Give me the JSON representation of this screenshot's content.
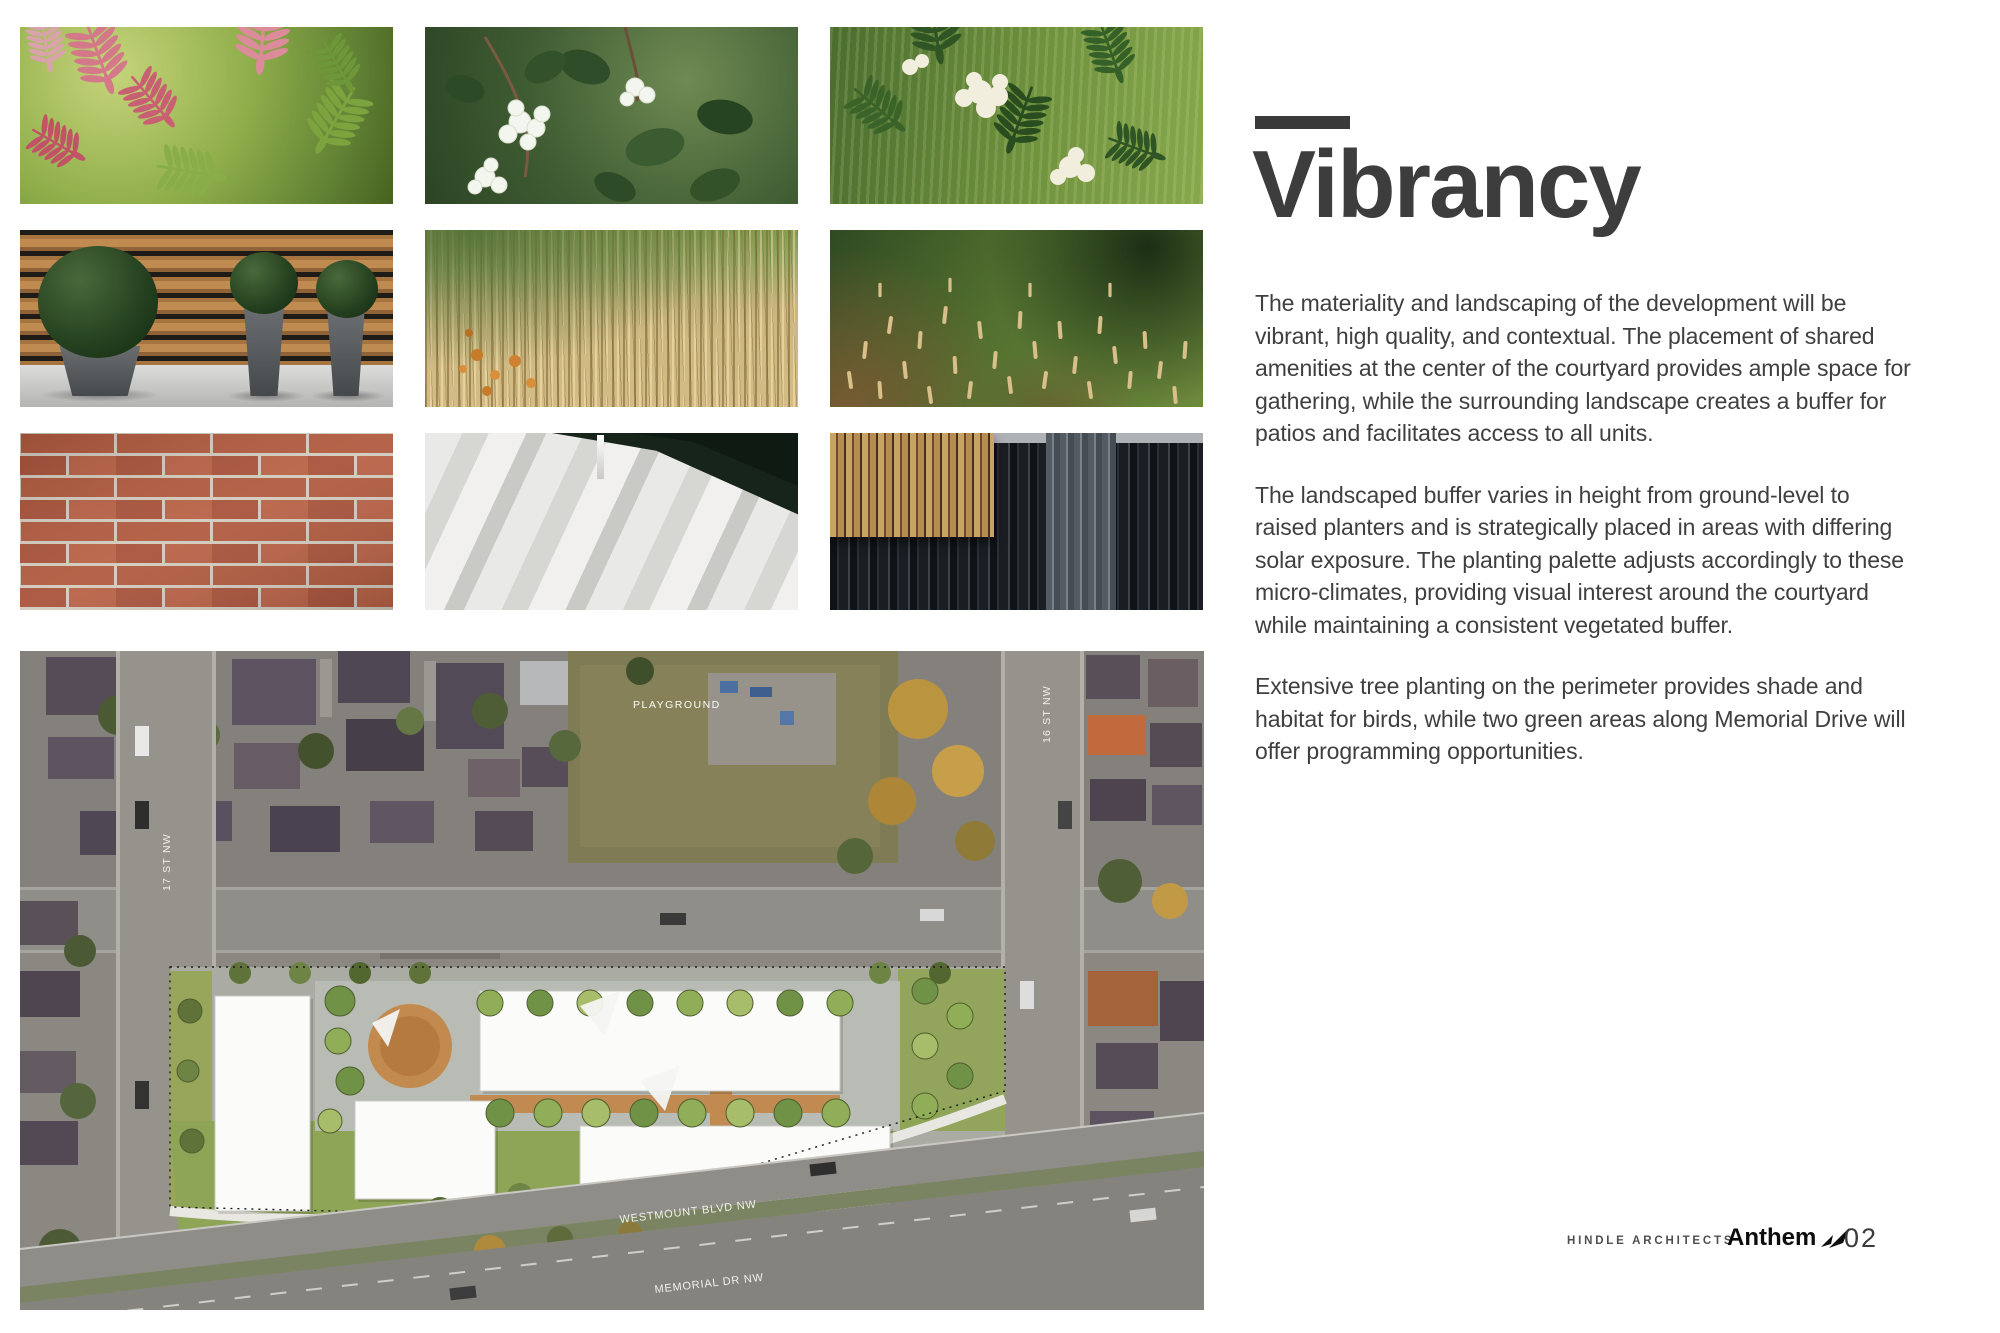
{
  "header": {
    "title": "Vibrancy"
  },
  "body": {
    "paragraphs": [
      "The materiality and landscaping of the development will be vibrant, high quality, and contextual. The placement of shared amenities at the center of the courtyard provides ample space for gathering, while the surrounding landscape creates a buffer for patios and facilitates access to all units.",
      "The landscaped buffer varies in height from ground-level to raised planters and is strategically placed in areas with differing solar exposure. The planting palette adjusts accordingly to these micro-climates, providing visual interest around the courtyard while maintaining a consistent vegetated buffer.",
      "Extensive tree planting on the perimeter provides shade and habitat for birds, while two green areas along Memorial Drive will offer programming opportunities."
    ]
  },
  "footer": {
    "architect": "HINDLE ARCHITECTS",
    "brand": "Anthem",
    "page_number": "02"
  },
  "site_plan": {
    "labels": {
      "playground": "PLAYGROUND",
      "street_left": "17 ST NW",
      "street_right": "16 ST NW",
      "boulevard": "WESTMOUNT BLVD NW",
      "drive": "MEMORIAL DR NW"
    }
  },
  "photos": [
    "false-spirea-pink-foliage",
    "snowberry-white-berries",
    "white-flower-shrub",
    "boxwood-topiary-planters",
    "feather-reed-grass",
    "mugo-pine-shrubs",
    "red-brick-wall",
    "concrete-paver-walkway",
    "wood-slat-and-metal-facade"
  ],
  "colors": {
    "accent_bar": "#3a3a3a",
    "title_text": "#3d3d3d",
    "body_text": "#3f3f3f"
  }
}
